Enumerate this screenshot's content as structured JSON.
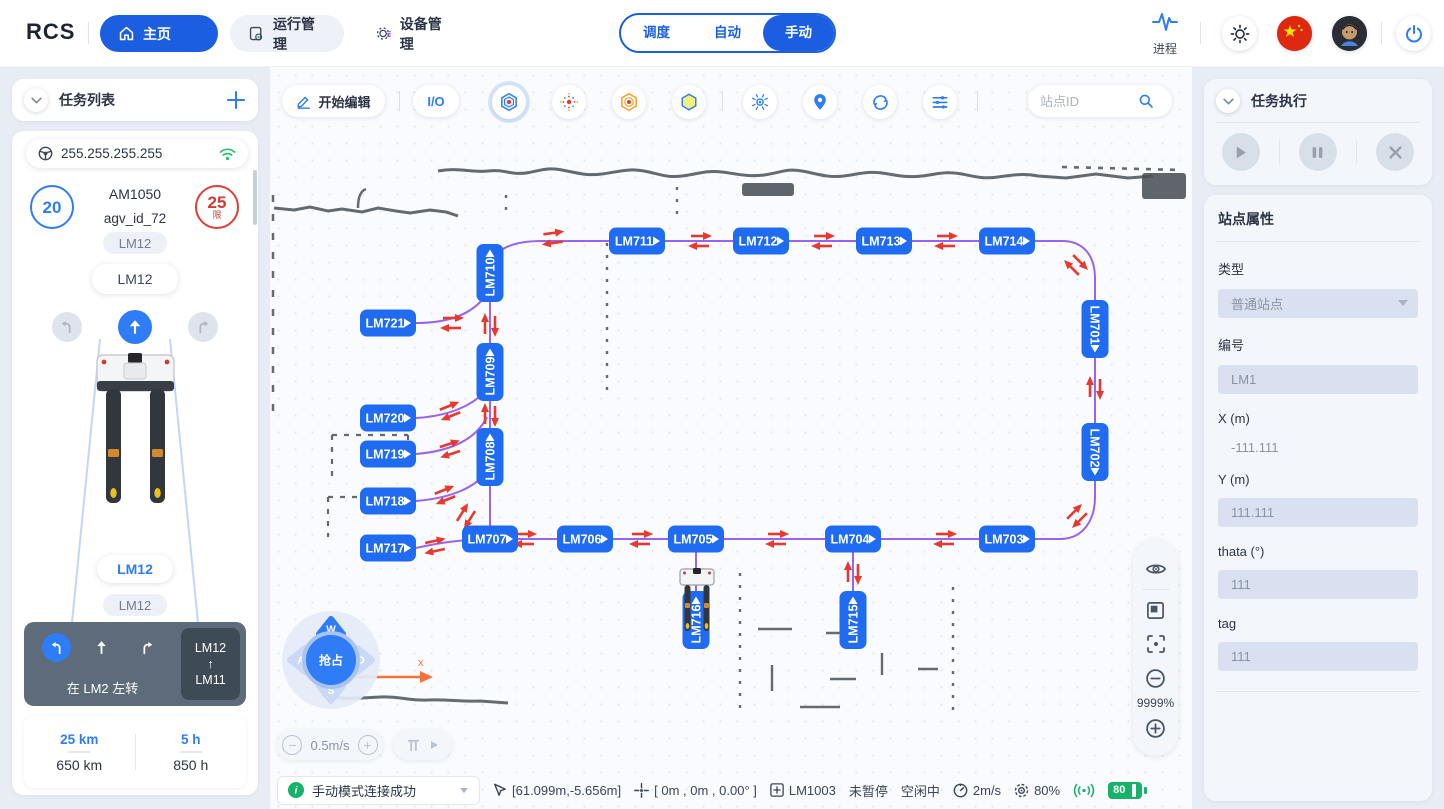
{
  "colors": {
    "accent_blue": "#1f6bf2",
    "green": "#17b26a",
    "red": "#e8392e",
    "route_purple": "#9a63ee"
  },
  "navbar": {
    "logo": "RCS",
    "tab_home": "主页",
    "tab_ops": "运行管理",
    "tab_device": "设备管理",
    "mode_dispatch": "调度",
    "mode_auto": "自动",
    "mode_manual": "手动",
    "process_label": "进程"
  },
  "left": {
    "panel_title": "任务列表",
    "ip": "255.255.255.255",
    "speed_badge": "20",
    "limit_value": "25",
    "limit_char": "限",
    "model": "AM1050",
    "agv_id": "agv_id_72",
    "station_top_small": "LM12",
    "station_top_pill": "LM12",
    "station_bottom_pill": "LM12",
    "station_bottom_small": "LM12",
    "nav_instruction": "在 LM2 左转",
    "nav_from": "LM12",
    "nav_arrow": "↑",
    "nav_to": "LM11",
    "odo_today": "25 km",
    "odo_total": "650 km",
    "hours_today": "5 h",
    "hours_total": "850 h"
  },
  "map": {
    "edit_button": "开始编辑",
    "io_button": "I/O",
    "search_placeholder": "站点ID",
    "zoom_level": "9999%",
    "speed_value": "0.5m/s",
    "axis_label": "x",
    "joystick": {
      "up": "W",
      "left": "A",
      "down": "S",
      "right": "D",
      "center": "抢占"
    },
    "stations": [
      {
        "id": "LM710",
        "x": 220,
        "y": 206,
        "o": "v",
        "t": "up"
      },
      {
        "id": "LM709",
        "x": 220,
        "y": 305,
        "o": "v",
        "t": "up"
      },
      {
        "id": "LM708",
        "x": 220,
        "y": 390,
        "o": "v",
        "t": "up"
      },
      {
        "id": "LM711",
        "x": 367,
        "y": 174,
        "o": "h",
        "t": "right"
      },
      {
        "id": "LM712",
        "x": 491,
        "y": 174,
        "o": "h",
        "t": "right"
      },
      {
        "id": "LM713",
        "x": 614,
        "y": 174,
        "o": "h",
        "t": "right"
      },
      {
        "id": "LM714",
        "x": 737,
        "y": 174,
        "o": "h",
        "t": "right"
      },
      {
        "id": "LM701",
        "x": 825,
        "y": 262,
        "o": "v",
        "t": "down"
      },
      {
        "id": "LM702",
        "x": 825,
        "y": 385,
        "o": "v",
        "t": "down"
      },
      {
        "id": "LM721",
        "x": 118,
        "y": 256,
        "o": "h",
        "t": "right"
      },
      {
        "id": "LM720",
        "x": 118,
        "y": 351,
        "o": "h",
        "t": "right"
      },
      {
        "id": "LM719",
        "x": 118,
        "y": 387,
        "o": "h",
        "t": "right"
      },
      {
        "id": "LM718",
        "x": 118,
        "y": 434,
        "o": "h",
        "t": "right"
      },
      {
        "id": "LM717",
        "x": 118,
        "y": 481,
        "o": "h",
        "t": "right"
      },
      {
        "id": "LM707",
        "x": 220,
        "y": 472,
        "o": "h",
        "t": "right"
      },
      {
        "id": "LM706",
        "x": 315,
        "y": 472,
        "o": "h",
        "t": "right"
      },
      {
        "id": "LM705",
        "x": 426,
        "y": 472,
        "o": "h",
        "t": "right"
      },
      {
        "id": "LM704",
        "x": 583,
        "y": 472,
        "o": "h",
        "t": "right"
      },
      {
        "id": "LM703",
        "x": 737,
        "y": 472,
        "o": "h",
        "t": "right"
      },
      {
        "id": "LM716",
        "x": 426,
        "y": 553,
        "o": "v",
        "t": "up"
      },
      {
        "id": "LM715",
        "x": 583,
        "y": 553,
        "o": "v",
        "t": "up"
      }
    ],
    "arrows": [
      {
        "x": 283,
        "y": 171,
        "r": -8
      },
      {
        "x": 430,
        "y": 174,
        "r": 0
      },
      {
        "x": 553,
        "y": 174,
        "r": 0
      },
      {
        "x": 676,
        "y": 174,
        "r": 0
      },
      {
        "x": 806,
        "y": 198,
        "r": 45
      },
      {
        "x": 825,
        "y": 321,
        "r": -90
      },
      {
        "x": 807,
        "y": 449,
        "r": -45
      },
      {
        "x": 675,
        "y": 472,
        "r": 0
      },
      {
        "x": 507,
        "y": 472,
        "r": 0
      },
      {
        "x": 371,
        "y": 472,
        "r": 0
      },
      {
        "x": 255,
        "y": 472,
        "r": 0
      },
      {
        "x": 583,
        "y": 506,
        "r": -90
      },
      {
        "x": 220,
        "y": 258,
        "r": -90
      },
      {
        "x": 220,
        "y": 348,
        "r": -90
      },
      {
        "x": 182,
        "y": 256,
        "r": 0
      },
      {
        "x": 180,
        "y": 344,
        "r": -22
      },
      {
        "x": 180,
        "y": 382,
        "r": -18
      },
      {
        "x": 175,
        "y": 428,
        "r": -22
      },
      {
        "x": 165,
        "y": 479,
        "r": -12
      },
      {
        "x": 196,
        "y": 449,
        "r": -58
      }
    ]
  },
  "right": {
    "panel_title": "任务执行",
    "props_title": "站点属性",
    "fields": [
      {
        "label": "类型",
        "value": "普通站点"
      },
      {
        "label": "编号",
        "value": "LM1"
      },
      {
        "label": "X (m)",
        "value": "-111.111"
      },
      {
        "label": "Y (m)",
        "value": "111.111"
      },
      {
        "label": "thata (°)",
        "value": "111"
      },
      {
        "label": "tag",
        "value": "111"
      }
    ]
  },
  "statusbar": {
    "message": "手动模式连接成功",
    "cursor_pos": "[61.099m,-5.656m]",
    "robot_pose": "[ 0m , 0m , 0.00° ]",
    "station": "LM1003",
    "pause_state": "未暂停",
    "idle_state": "空闲中",
    "speed": "2m/s",
    "localization": "80%",
    "battery": "80"
  }
}
